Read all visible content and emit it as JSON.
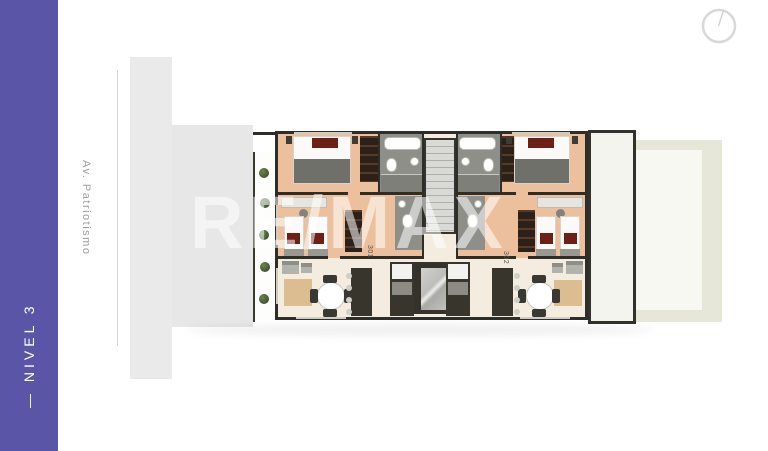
{
  "level_banner": {
    "label": "— NIVEL 3"
  },
  "street": {
    "label": "Av. Patriotismo"
  },
  "watermark": {
    "label": "RE/MAX"
  },
  "compass": {
    "icon": "compass-icon"
  },
  "floorplan": {
    "unit_left": {
      "number": "301"
    },
    "unit_right": {
      "number": "302"
    }
  },
  "colors": {
    "accent_purple": "#5a55a6",
    "bedroom_floor": "#ecc09c",
    "living_floor": "#f3ecdf",
    "bathroom_floor": "#8f8f89",
    "wall": "#2f2d28",
    "terrace": "#e6e6d9",
    "context_building": "#e9e9e9",
    "street_text": "#9c9c9c"
  }
}
